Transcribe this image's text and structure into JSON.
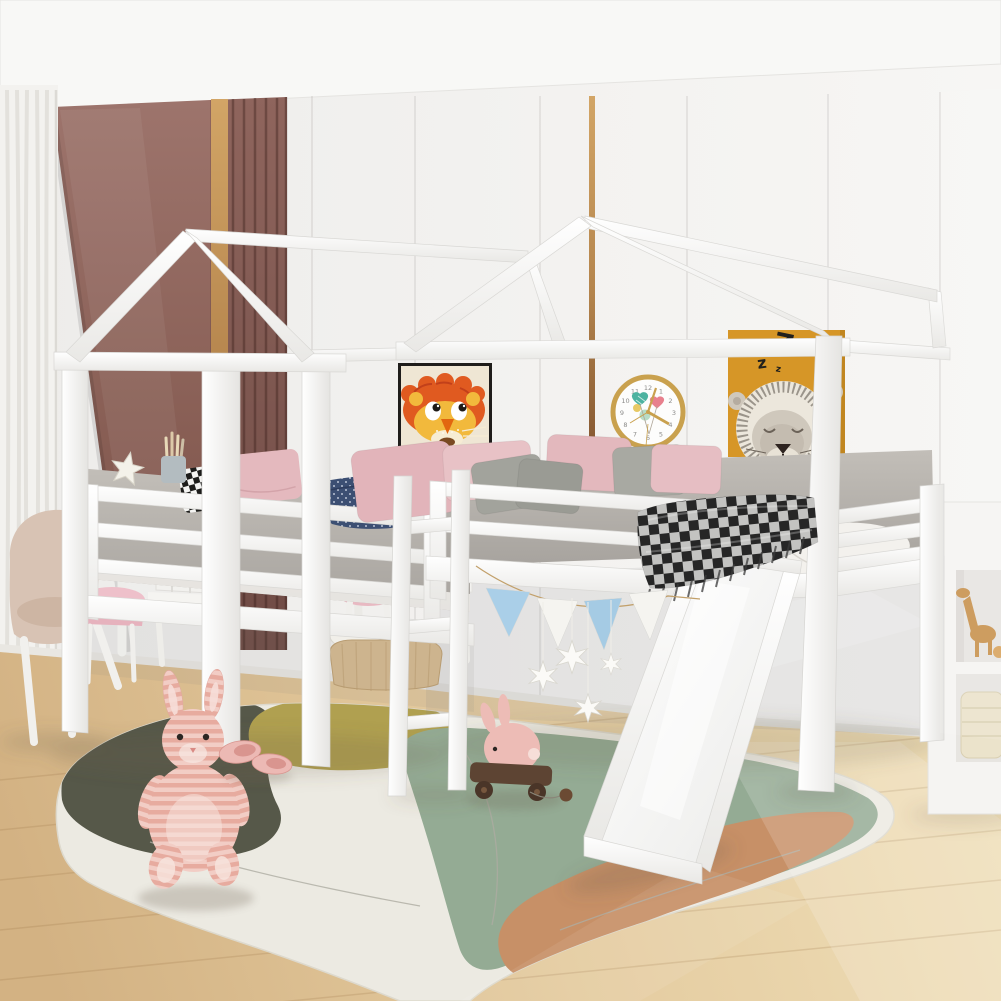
{
  "meta": {
    "domain": "natural-image",
    "subject": "Kids bedroom with two white house-frame loft beds in an L-shape, one with a slide",
    "description": "Product-style photo: white wooden house loft beds with ladder and slide, abstract area rug, plush toys and pastel decor"
  },
  "poster_lion": {
    "label": "sleeping lion poster",
    "background": "#d69627",
    "z_large": "Z",
    "z_medium": "z",
    "z_small": "z"
  },
  "clock": {
    "label": "balloon wall clock",
    "rim_color": "#c9a14e",
    "numerals": [
      "12",
      "1",
      "2",
      "3",
      "4",
      "5",
      "6",
      "7",
      "8",
      "9",
      "10",
      "11"
    ]
  },
  "print_tiger": {
    "label": "tiger art print",
    "background": "#efe6d4",
    "frame": "#1f1d1b"
  },
  "palette": {
    "wall": "#f2f1ef",
    "ceiling": "#f8f8f6",
    "accent_panel": "#96695f",
    "wood_trim": "#b5854d",
    "floor": "#e3c99d",
    "bed_frame": "#fcfcfb",
    "rug_base": "#eceae2",
    "rug_dark": "#565849",
    "rug_green": "#94ab94",
    "rug_olive": "#b0a050",
    "rug_terracotta": "#c79067",
    "pillow_pink": "#e3b8bd",
    "pillow_gray": "#a3a49d",
    "bunting_blue": "#aacfe8",
    "bunny_pink": "#eebcb3"
  },
  "objects": {
    "left_bed": "house-frame loft bed (side view)",
    "right_bed": "house-frame loft bed with slide",
    "slide": "white slide",
    "ladder": "white ladder",
    "bunting": "blue and white pennant garland",
    "stars": "hanging white star ornaments",
    "rug": "abstract organic-shape area rug",
    "bunny_plush": "striped pink bunny plush",
    "slippers": "pink slippers",
    "pull_toy": "pink bunny pull toy on wooden wheels",
    "storage_basket": "wicker basket with rolled blankets",
    "cubby_shelf": "white cubby shelf with wooden giraffe toy and cream basket",
    "kids_desk": "white desk with pink drawers",
    "armchair": "beige kids armchair",
    "stool": "pink stool",
    "side_chair": "pink chair",
    "curtain": "white sheer curtain",
    "accent_wall": "mauve panel wall with wood slats and brass trim",
    "pillows": "pink, gray, gingham and navy pillows",
    "blanket": "black-white buffalo plaid throw with fringe",
    "starfish": "white starfish ornament",
    "pencil_cup": "cup with pencils"
  }
}
